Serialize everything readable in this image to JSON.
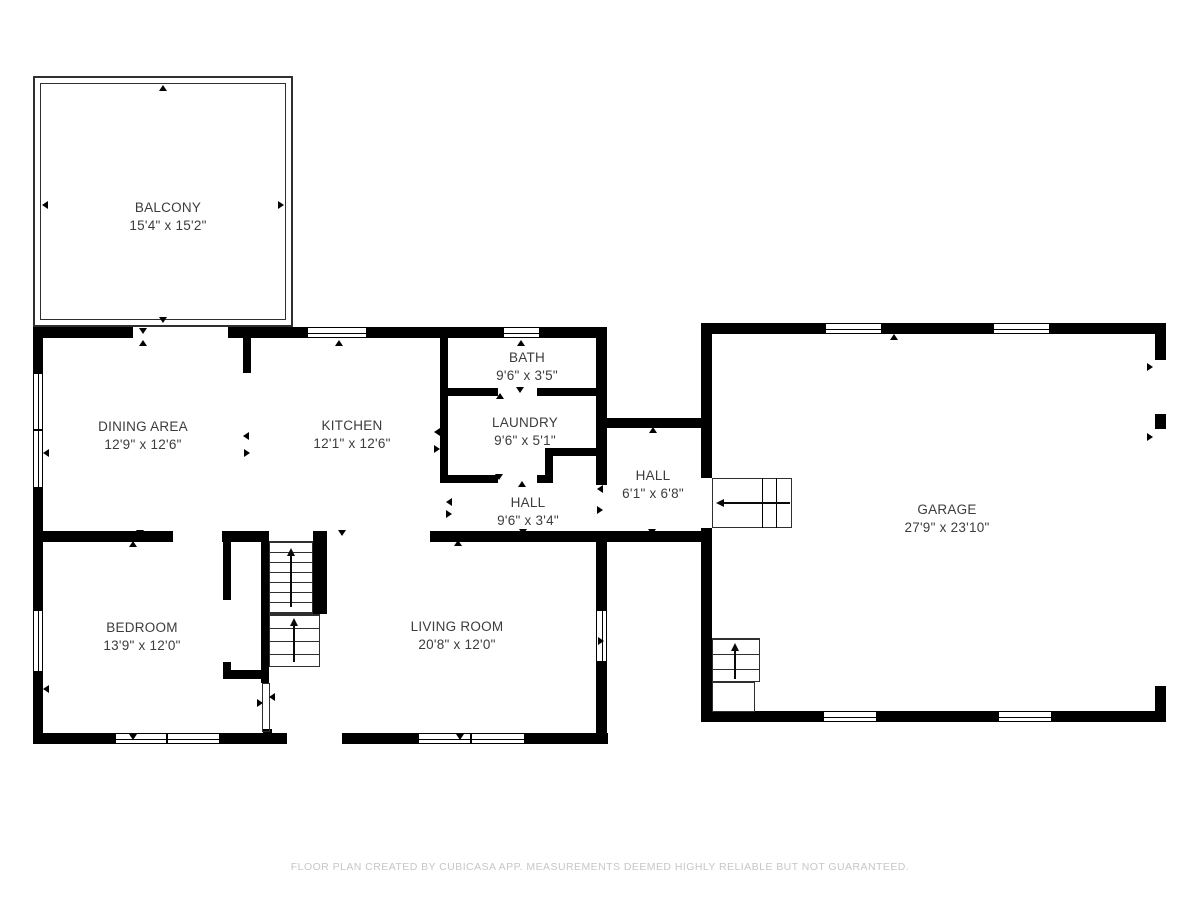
{
  "footer": {
    "text": "FLOOR PLAN CREATED BY CUBICASA APP. MEASUREMENTS DEEMED HIGHLY RELIABLE BUT NOT GUARANTEED."
  },
  "colors": {
    "wall": "#000000",
    "thin_line": "#2f2f2f",
    "label": "#3c3c3c",
    "footer_text": "#c6c6c6",
    "background": "#ffffff"
  },
  "rooms": [
    {
      "id": "balcony",
      "name": "BALCONY",
      "dims": "15'4\" x 15'2\"",
      "cx": 168,
      "cy": 217
    },
    {
      "id": "dining-area",
      "name": "DINING AREA",
      "dims": "12'9\" x 12'6\"",
      "cx": 143,
      "cy": 436
    },
    {
      "id": "kitchen",
      "name": "KITCHEN",
      "dims": "12'1\" x 12'6\"",
      "cx": 352,
      "cy": 435
    },
    {
      "id": "bath",
      "name": "BATH",
      "dims": "9'6\" x 3'5\"",
      "cx": 527,
      "cy": 367
    },
    {
      "id": "laundry",
      "name": "LAUNDRY",
      "dims": "9'6\" x 5'1\"",
      "cx": 525,
      "cy": 432
    },
    {
      "id": "hall-upper",
      "name": "HALL",
      "dims": "6'1\" x 6'8\"",
      "cx": 653,
      "cy": 485
    },
    {
      "id": "hall-center",
      "name": "HALL",
      "dims": "9'6\" x 3'4\"",
      "cx": 528,
      "cy": 512
    },
    {
      "id": "garage",
      "name": "GARAGE",
      "dims": "27'9\" x 23'10\"",
      "cx": 947,
      "cy": 519
    },
    {
      "id": "bedroom",
      "name": "BEDROOM",
      "dims": "13'9\" x 12'0\"",
      "cx": 142,
      "cy": 637
    },
    {
      "id": "living-room",
      "name": "LIVING ROOM",
      "dims": "20'8\" x 12'0\"",
      "cx": 457,
      "cy": 636
    }
  ],
  "walls": [
    {
      "name": "house-top-wall-a",
      "x": 33,
      "y": 327,
      "w": 100,
      "h": 11
    },
    {
      "name": "house-top-wall-b",
      "x": 228,
      "y": 327,
      "w": 79,
      "h": 11
    },
    {
      "name": "house-top-wall-c",
      "x": 367,
      "y": 327,
      "w": 136,
      "h": 11
    },
    {
      "name": "house-top-wall-d",
      "x": 540,
      "y": 327,
      "w": 67,
      "h": 11
    },
    {
      "name": "house-left-wall-a",
      "x": 33,
      "y": 327,
      "w": 10,
      "h": 46
    },
    {
      "name": "house-left-wall-b",
      "x": 33,
      "y": 488,
      "w": 10,
      "h": 122
    },
    {
      "name": "house-left-wall-c",
      "x": 33,
      "y": 672,
      "w": 10,
      "h": 72
    },
    {
      "name": "house-bottom-wall-a",
      "x": 33,
      "y": 733,
      "w": 82,
      "h": 11
    },
    {
      "name": "house-bottom-wall-b",
      "x": 220,
      "y": 733,
      "w": 67,
      "h": 11
    },
    {
      "name": "house-bottom-wall-c",
      "x": 342,
      "y": 733,
      "w": 76,
      "h": 11
    },
    {
      "name": "house-bottom-wall-d",
      "x": 525,
      "y": 733,
      "w": 83,
      "h": 11
    },
    {
      "name": "house-right-wall-a",
      "x": 596,
      "y": 327,
      "w": 11,
      "h": 158
    },
    {
      "name": "house-right-wall-b",
      "x": 596,
      "y": 531,
      "w": 11,
      "h": 79
    },
    {
      "name": "house-right-wall-c",
      "x": 596,
      "y": 662,
      "w": 11,
      "h": 82
    },
    {
      "name": "dining-kitchen-stub",
      "x": 243,
      "y": 338,
      "w": 8,
      "h": 35
    },
    {
      "name": "kitchen-divider-wall",
      "x": 440,
      "y": 338,
      "w": 8,
      "h": 144
    },
    {
      "name": "bath-bottom-wall-a",
      "x": 448,
      "y": 388,
      "w": 50,
      "h": 8
    },
    {
      "name": "bath-bottom-wall-b",
      "x": 537,
      "y": 388,
      "w": 59,
      "h": 8
    },
    {
      "name": "laundry-bottom-wall-a",
      "x": 440,
      "y": 475,
      "w": 58,
      "h": 8
    },
    {
      "name": "laundry-bottom-wall-b",
      "x": 537,
      "y": 475,
      "w": 16,
      "h": 8
    },
    {
      "name": "laundry-notch-wall-v",
      "x": 545,
      "y": 448,
      "w": 8,
      "h": 35
    },
    {
      "name": "laundry-notch-wall-h",
      "x": 545,
      "y": 448,
      "w": 51,
      "h": 8
    },
    {
      "name": "mid-wall-a",
      "x": 33,
      "y": 531,
      "w": 140,
      "h": 11
    },
    {
      "name": "mid-wall-b",
      "x": 222,
      "y": 531,
      "w": 47,
      "h": 11
    },
    {
      "name": "mid-wall-c",
      "x": 430,
      "y": 531,
      "w": 166,
      "h": 11
    },
    {
      "name": "closet-left-wall-a",
      "x": 223,
      "y": 531,
      "w": 8,
      "h": 69
    },
    {
      "name": "closet-left-wall-b",
      "x": 223,
      "y": 662,
      "w": 8,
      "h": 17
    },
    {
      "name": "closet-bottom-wall",
      "x": 223,
      "y": 670,
      "w": 44,
      "h": 9
    },
    {
      "name": "stair-left-wall",
      "x": 261,
      "y": 531,
      "w": 8,
      "h": 152
    },
    {
      "name": "stair-right-wall",
      "x": 313,
      "y": 531,
      "w": 14,
      "h": 83
    },
    {
      "name": "exthall-top-wall",
      "x": 607,
      "y": 418,
      "w": 95,
      "h": 10
    },
    {
      "name": "exthall-bottom-wall",
      "x": 596,
      "y": 531,
      "w": 106,
      "h": 11
    },
    {
      "name": "garage-top-wall-a",
      "x": 701,
      "y": 323,
      "w": 124,
      "h": 11
    },
    {
      "name": "garage-top-wall-b",
      "x": 882,
      "y": 323,
      "w": 111,
      "h": 11
    },
    {
      "name": "garage-top-wall-c",
      "x": 1050,
      "y": 323,
      "w": 116,
      "h": 11
    },
    {
      "name": "garage-left-wall-a",
      "x": 701,
      "y": 323,
      "w": 11,
      "h": 155
    },
    {
      "name": "garage-left-wall-b",
      "x": 701,
      "y": 528,
      "w": 11,
      "h": 193
    },
    {
      "name": "garage-right-wall-a",
      "x": 1155,
      "y": 323,
      "w": 11,
      "h": 37
    },
    {
      "name": "garage-right-pier",
      "x": 1155,
      "y": 414,
      "w": 11,
      "h": 15
    },
    {
      "name": "garage-right-wall-b",
      "x": 1155,
      "y": 686,
      "w": 11,
      "h": 36
    },
    {
      "name": "garage-bottom-wall-a",
      "x": 701,
      "y": 711,
      "w": 122,
      "h": 11
    },
    {
      "name": "garage-bottom-wall-b",
      "x": 877,
      "y": 711,
      "w": 121,
      "h": 11
    },
    {
      "name": "garage-bottom-wall-c",
      "x": 1052,
      "y": 711,
      "w": 114,
      "h": 11
    },
    {
      "name": "entry-stub",
      "x": 263,
      "y": 729,
      "w": 9,
      "h": 4
    }
  ],
  "windows": [
    {
      "name": "window-top-kitchen",
      "x": 307,
      "y": 327,
      "w": 60,
      "h": 11,
      "o": "h",
      "m": []
    },
    {
      "name": "window-top-bath",
      "x": 503,
      "y": 327,
      "w": 37,
      "h": 11,
      "o": "h",
      "m": []
    },
    {
      "name": "window-left-dining",
      "x": 33,
      "y": 373,
      "w": 10,
      "h": 115,
      "o": "v",
      "m": [
        0.49
      ]
    },
    {
      "name": "window-left-bedroom",
      "x": 33,
      "y": 610,
      "w": 10,
      "h": 62,
      "o": "v",
      "m": []
    },
    {
      "name": "window-bottom-bedroom",
      "x": 115,
      "y": 733,
      "w": 105,
      "h": 11,
      "o": "h",
      "m": [
        0.49
      ]
    },
    {
      "name": "window-bottom-living",
      "x": 418,
      "y": 733,
      "w": 107,
      "h": 11,
      "o": "h",
      "m": [
        0.49
      ]
    },
    {
      "name": "window-right-living",
      "x": 596,
      "y": 610,
      "w": 11,
      "h": 52,
      "o": "v",
      "m": []
    },
    {
      "name": "window-garage-top-a",
      "x": 825,
      "y": 323,
      "w": 57,
      "h": 11,
      "o": "h",
      "m": []
    },
    {
      "name": "window-garage-top-b",
      "x": 993,
      "y": 323,
      "w": 57,
      "h": 11,
      "o": "h",
      "m": []
    },
    {
      "name": "window-garage-bottom-a",
      "x": 823,
      "y": 711,
      "w": 54,
      "h": 11,
      "o": "h",
      "m": []
    },
    {
      "name": "window-garage-bottom-b",
      "x": 998,
      "y": 711,
      "w": 54,
      "h": 11,
      "o": "h",
      "m": []
    }
  ],
  "thin_rects": [
    {
      "name": "balcony-outer-rail",
      "x": 33,
      "y": 76,
      "w": 260,
      "h": 251,
      "bw": 2
    },
    {
      "name": "balcony-inner-rail",
      "x": 40,
      "y": 83,
      "w": 246,
      "h": 237,
      "bw": 1
    },
    {
      "name": "entry-vestibule-rail",
      "x": 262,
      "y": 683,
      "w": 8,
      "h": 49,
      "bw": 1
    },
    {
      "name": "hall-stairs-box",
      "x": 712,
      "y": 478,
      "w": 80,
      "h": 50,
      "bw": 1
    },
    {
      "name": "garage-stairs-landing",
      "x": 712,
      "y": 682,
      "w": 43,
      "h": 30,
      "bw": 1
    }
  ],
  "stairs": [
    {
      "name": "main-stairs-upper-flight",
      "x": 269,
      "y": 541,
      "w": 44,
      "h": 73,
      "tread": 10
    },
    {
      "name": "main-stairs-lower-flight",
      "x": 269,
      "y": 614,
      "w": 51,
      "h": 53,
      "tread": 13
    },
    {
      "name": "garage-stairs-treads",
      "x": 712,
      "y": 638,
      "w": 48,
      "h": 44,
      "tread": 15
    }
  ],
  "lines": [
    {
      "name": "hall-stairs-tread-1",
      "x": 762,
      "y": 478,
      "w": 1,
      "h": 50
    },
    {
      "name": "hall-stairs-tread-2",
      "x": 776,
      "y": 478,
      "w": 1,
      "h": 50
    }
  ],
  "arrows": [
    {
      "name": "stairs-direction-arrow-main-upper",
      "x1": 291,
      "y1": 607,
      "x2": 291,
      "y2": 549,
      "dir": "up"
    },
    {
      "name": "stairs-direction-arrow-main-lower",
      "x1": 294,
      "y1": 662,
      "x2": 294,
      "y2": 619,
      "dir": "up"
    },
    {
      "name": "stairs-direction-arrow-hall",
      "x1": 790,
      "y1": 503,
      "x2": 717,
      "y2": 503,
      "dir": "left"
    },
    {
      "name": "stairs-direction-arrow-garage",
      "x1": 735,
      "y1": 679,
      "x2": 735,
      "y2": 644,
      "dir": "up"
    }
  ],
  "markers": [
    {
      "name": "marker-balcony-top",
      "x": 163,
      "y": 88,
      "dir": "up"
    },
    {
      "name": "marker-balcony-left",
      "x": 45,
      "y": 205,
      "dir": "left"
    },
    {
      "name": "marker-balcony-right",
      "x": 281,
      "y": 205,
      "dir": "right"
    },
    {
      "name": "marker-balcony-bottom",
      "x": 163,
      "y": 320,
      "dir": "down"
    },
    {
      "name": "marker-balcony-door-a",
      "x": 143,
      "y": 331,
      "dir": "down"
    },
    {
      "name": "marker-balcony-door-b",
      "x": 143,
      "y": 343,
      "dir": "up"
    },
    {
      "name": "marker-window-top-kitchen",
      "x": 339,
      "y": 343,
      "dir": "up"
    },
    {
      "name": "marker-window-top-bath",
      "x": 521,
      "y": 343,
      "dir": "up"
    },
    {
      "name": "marker-window-left-dining",
      "x": 46,
      "y": 453,
      "dir": "left"
    },
    {
      "name": "marker-window-left-bedroom",
      "x": 46,
      "y": 689,
      "dir": "left"
    },
    {
      "name": "marker-window-bottom-bedroom",
      "x": 133,
      "y": 737,
      "dir": "down"
    },
    {
      "name": "marker-window-bottom-living",
      "x": 460,
      "y": 737,
      "dir": "down"
    },
    {
      "name": "marker-window-right-living",
      "x": 601,
      "y": 641,
      "dir": "right"
    },
    {
      "name": "marker-garage-top",
      "x": 894,
      "y": 337,
      "dir": "up"
    },
    {
      "name": "marker-garage-bottom",
      "x": 894,
      "y": 715,
      "dir": "down"
    },
    {
      "name": "marker-garage-door-a",
      "x": 1150,
      "y": 367,
      "dir": "right"
    },
    {
      "name": "marker-garage-door-b",
      "x": 1150,
      "y": 437,
      "dir": "right"
    },
    {
      "name": "marker-bath-door-a",
      "x": 520,
      "y": 390,
      "dir": "down"
    },
    {
      "name": "marker-bath-door-b",
      "x": 500,
      "y": 396,
      "dir": "up"
    },
    {
      "name": "marker-laundry-door-a",
      "x": 499,
      "y": 477,
      "dir": "down"
    },
    {
      "name": "marker-laundry-door-b",
      "x": 522,
      "y": 484,
      "dir": "up"
    },
    {
      "name": "marker-kitchen-divider-a",
      "x": 437,
      "y": 432,
      "dir": "left"
    },
    {
      "name": "marker-kitchen-divider-b",
      "x": 437,
      "y": 449,
      "dir": "right"
    },
    {
      "name": "marker-dining-stub-a",
      "x": 246,
      "y": 436,
      "dir": "left"
    },
    {
      "name": "marker-dining-stub-b",
      "x": 247,
      "y": 453,
      "dir": "right"
    },
    {
      "name": "marker-kitchen-hall-door-a",
      "x": 449,
      "y": 502,
      "dir": "left"
    },
    {
      "name": "marker-kitchen-hall-door-b",
      "x": 449,
      "y": 514,
      "dir": "right"
    },
    {
      "name": "marker-right-wall-door-a",
      "x": 600,
      "y": 489,
      "dir": "left"
    },
    {
      "name": "marker-right-wall-door-b",
      "x": 600,
      "y": 510,
      "dir": "right"
    },
    {
      "name": "marker-exthall-top",
      "x": 653,
      "y": 430,
      "dir": "up"
    },
    {
      "name": "marker-exthall-bottom",
      "x": 652,
      "y": 532,
      "dir": "down"
    },
    {
      "name": "marker-kitchen-living-opening",
      "x": 342,
      "y": 533,
      "dir": "down"
    },
    {
      "name": "marker-hall-bottom",
      "x": 458,
      "y": 543,
      "dir": "up"
    },
    {
      "name": "marker-hall-top",
      "x": 523,
      "y": 532,
      "dir": "down"
    },
    {
      "name": "marker-bedroom-door-a",
      "x": 140,
      "y": 533,
      "dir": "down"
    },
    {
      "name": "marker-bedroom-door-b",
      "x": 133,
      "y": 544,
      "dir": "up"
    },
    {
      "name": "marker-front-door-a",
      "x": 260,
      "y": 703,
      "dir": "right"
    },
    {
      "name": "marker-front-door-b",
      "x": 272,
      "y": 697,
      "dir": "left"
    }
  ]
}
